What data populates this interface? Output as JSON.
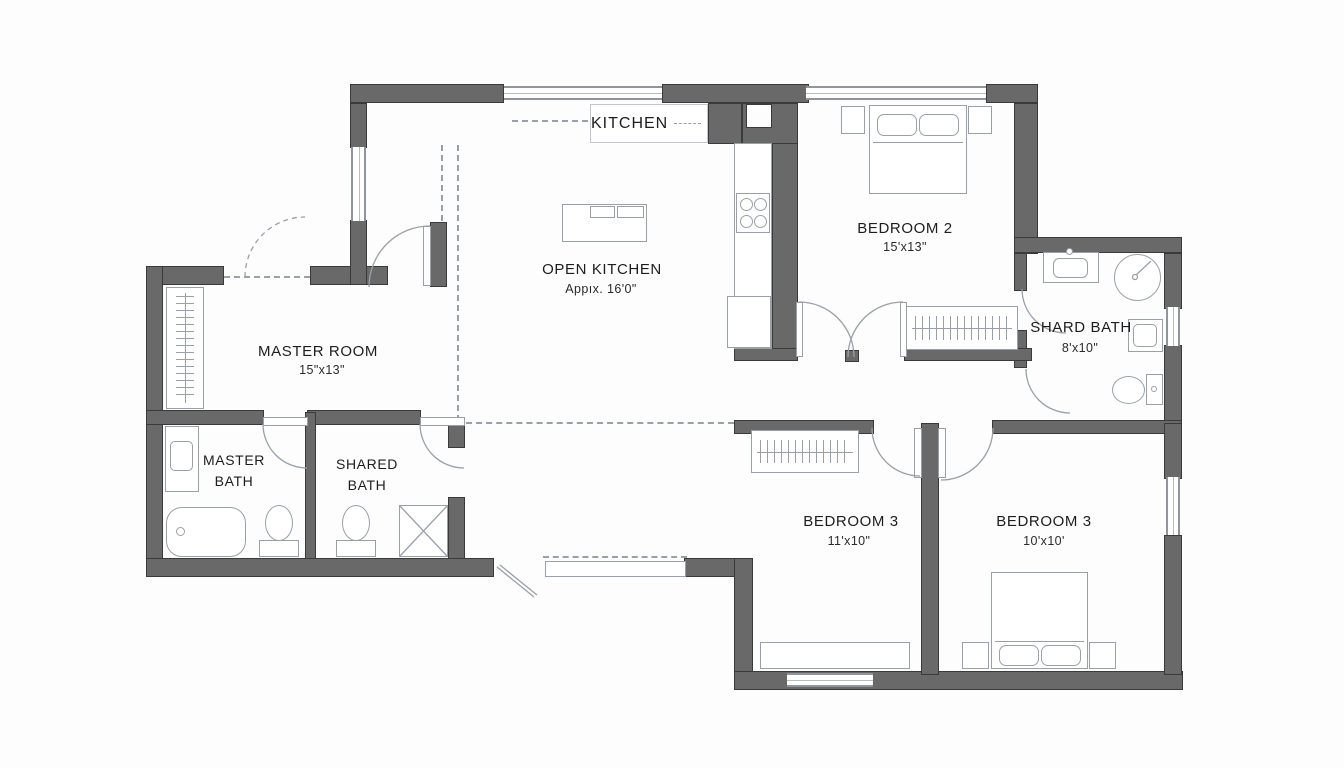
{
  "title": "Apartment floor plan",
  "colors": {
    "wall": "#696969",
    "wall_edge": "#3a3a3a",
    "fixture_line": "#9aa0a6",
    "text": "#1d1d1d"
  },
  "rooms": {
    "kitchen": {
      "label": "KITCHEN"
    },
    "open_kitchen": {
      "label": "OPEN KITCHEN",
      "area": "Appıx. 16'0\""
    },
    "master_room": {
      "label": "MASTER ROOM",
      "dims": "15\"x13\""
    },
    "master_bath": {
      "label_line1": "MASTER",
      "label_line2": "BATH"
    },
    "shared_bath": {
      "label_line1": "SHARED",
      "label_line2": "BATH"
    },
    "bedroom2": {
      "label": "BEDROOM 2",
      "dims": "15'x13\""
    },
    "shard_bath": {
      "label": "SHARD BATH",
      "dims": "8'x10\""
    },
    "bedroom3_left": {
      "label": "BEDROOM 3",
      "dims": "11'x10\""
    },
    "bedroom3_right": {
      "label": "BEDROOM 3",
      "dims": "10'x10'"
    }
  },
  "fixtures": [
    "kitchen-counter",
    "stove",
    "fridge",
    "kitchen-island",
    "double-bed",
    "nightstand",
    "closet",
    "dresser",
    "vanity-sink",
    "wall-sink",
    "round-shower",
    "shower-stall",
    "bathtub",
    "toilet",
    "window",
    "door-swing"
  ]
}
